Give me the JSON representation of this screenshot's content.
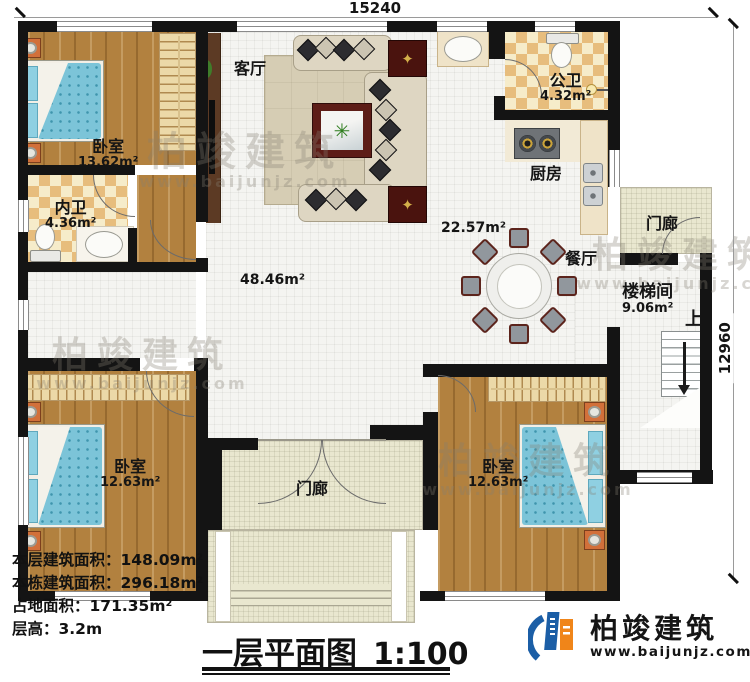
{
  "dims": {
    "top": "15240",
    "right": "12960"
  },
  "labels": {
    "living": "客厅",
    "bedroom_tl": "卧室",
    "bedroom_tl_area": "13.62m²",
    "bath_inner": "内卫",
    "bath_inner_area": "4.36m²",
    "bath_public": "公卫",
    "bath_public_area": "4.32m²",
    "kitchen": "厨房",
    "dining": "餐厅",
    "dining_area": "22.57m²",
    "hall_area": "48.46m²",
    "stairwell": "楼梯间",
    "stairwell_area": "9.06m²",
    "up": "上",
    "porch_right": "门廊",
    "porch_bottom": "门廊",
    "bedroom_bl": "卧室",
    "bedroom_bl_area": "12.63m²",
    "bedroom_br": "卧室",
    "bedroom_br_area": "12.63m²"
  },
  "info": {
    "floor_area": "本层建筑面积：148.09m²",
    "total_area": "本栋建筑面积：296.18m²",
    "land_area": "占地面积：171.35m²",
    "floor_height": "层高：3.2m"
  },
  "title": {
    "name": "一层平面图",
    "scale": "1:100"
  },
  "logo": {
    "brand": "柏竣建筑",
    "site": "www.baijunjz.com"
  },
  "watermark": {
    "brand": "柏竣建筑",
    "site": "www.baijunjz.com"
  },
  "colors": {
    "wall": "#141414",
    "wood": "#b2813f",
    "tile": "#f4f4f1",
    "checker": "#e7bd7d",
    "porch": "#e9e7cf",
    "bed_blue": "#7cc4d8",
    "nightstand": "#d2703a",
    "logo_blue": "#1b5ea6",
    "logo_orange": "#f08519"
  }
}
